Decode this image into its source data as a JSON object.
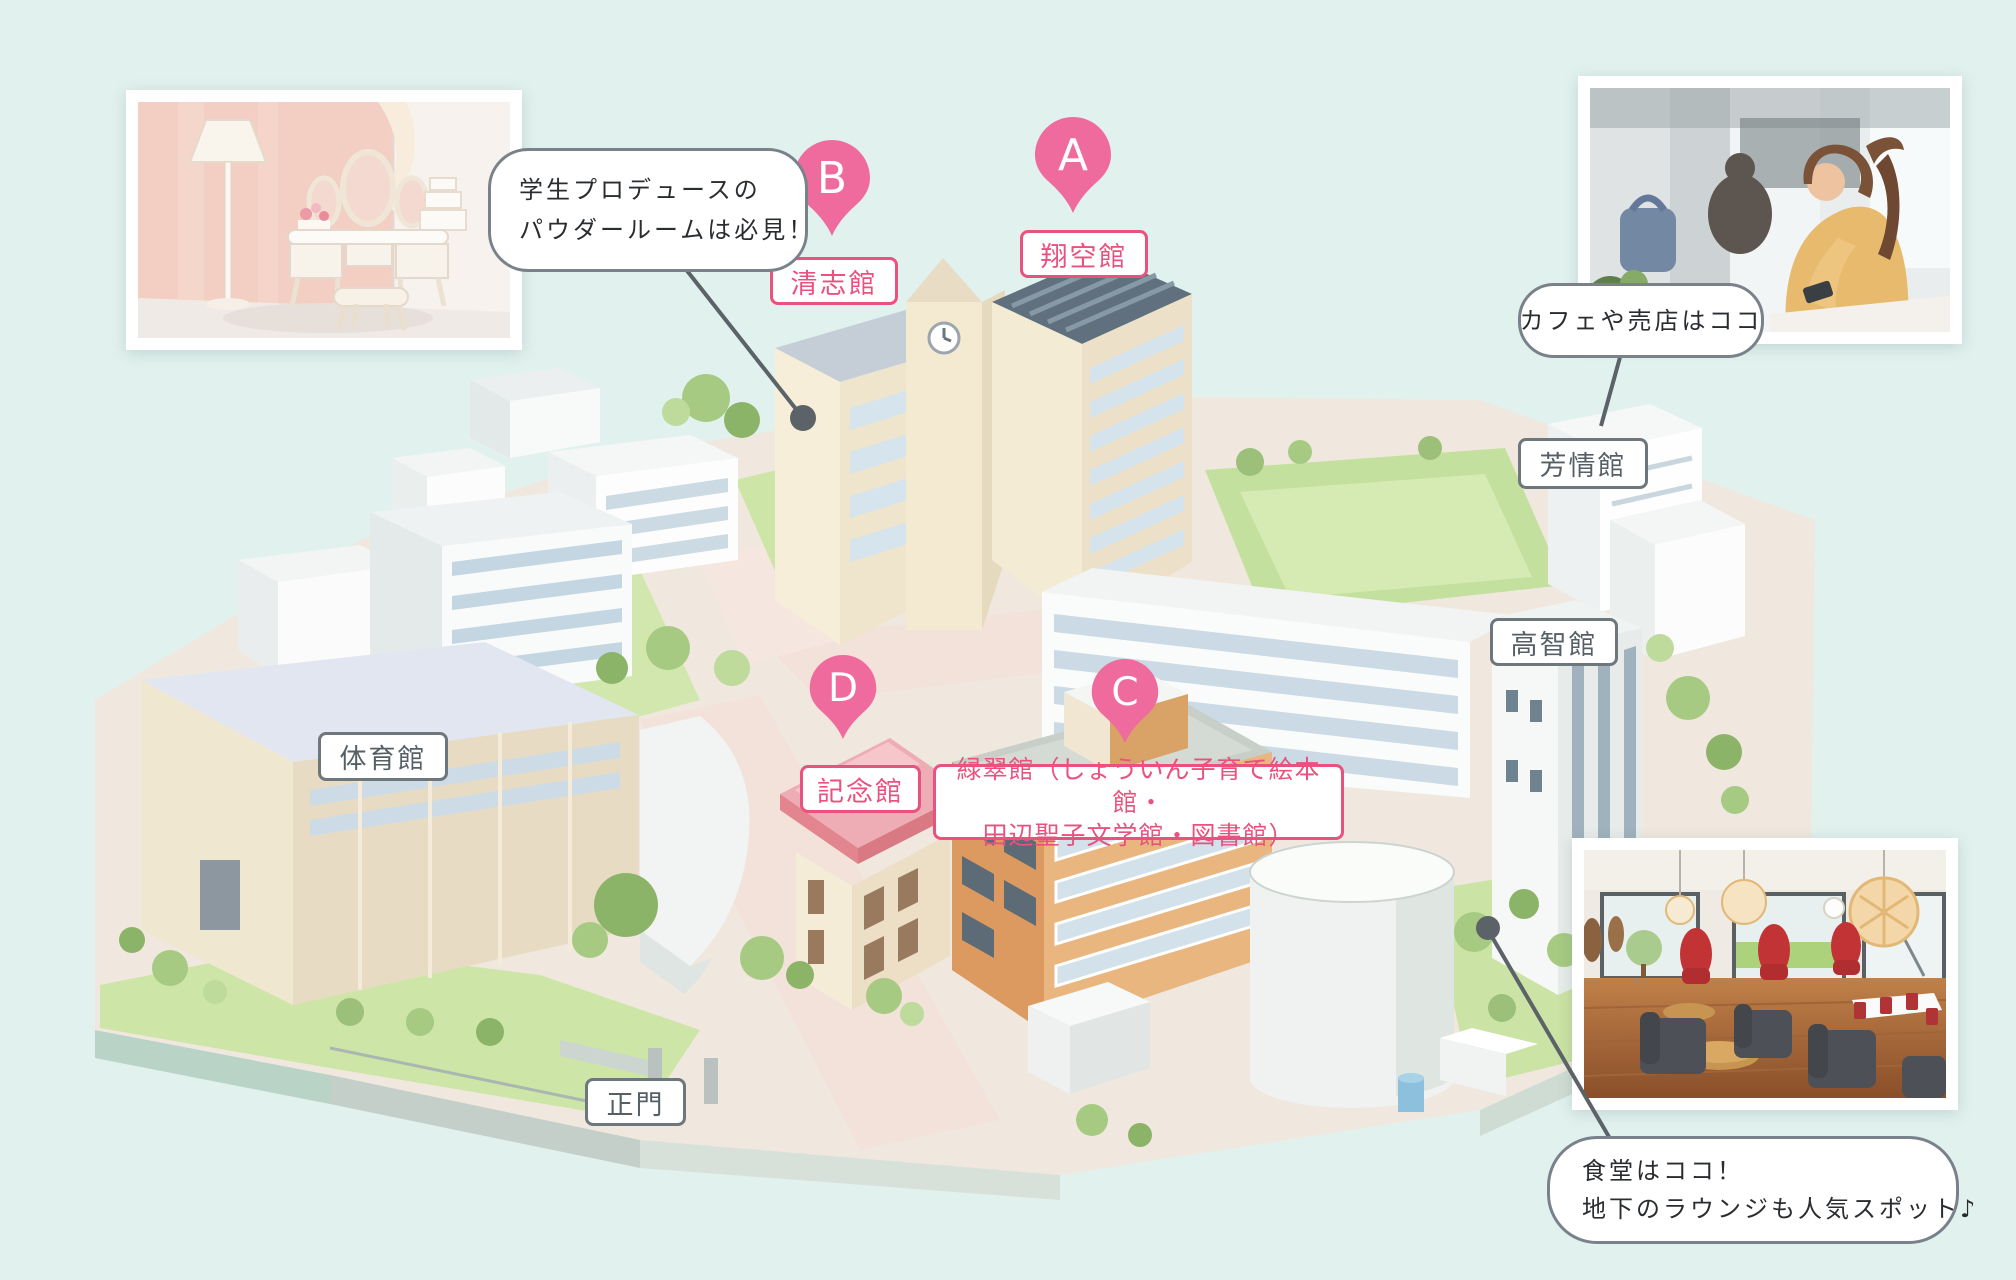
{
  "pins": [
    {
      "letter": "A",
      "building": "翔空館"
    },
    {
      "letter": "B",
      "building": "清志館"
    },
    {
      "letter": "C",
      "building_line1": "緑翠館（しょういん子育て絵本館・",
      "building_line2": "田辺聖子文学館・図書館）"
    },
    {
      "letter": "D",
      "building": "記念館"
    }
  ],
  "building_labels": [
    {
      "text": "体育館"
    },
    {
      "text": "芳情館"
    },
    {
      "text": "高智館"
    },
    {
      "text": "正門"
    }
  ],
  "callouts": [
    {
      "line1": "学生プロデュースの",
      "line2": "パウダールームは必見！"
    },
    {
      "line1": "カフェや売店はココ"
    },
    {
      "line1": "食堂はココ！",
      "line2": "地下のラウンジも人気スポット♪"
    }
  ],
  "colors": {
    "background": "#e1f1ee",
    "pin_pink": "#ef6a9d",
    "pink_label": "#e9517e",
    "gray_label_border": "#6e777c",
    "gray_label_text": "#555f66",
    "callout_border": "#79828a",
    "leader_line": "#5b6268"
  }
}
